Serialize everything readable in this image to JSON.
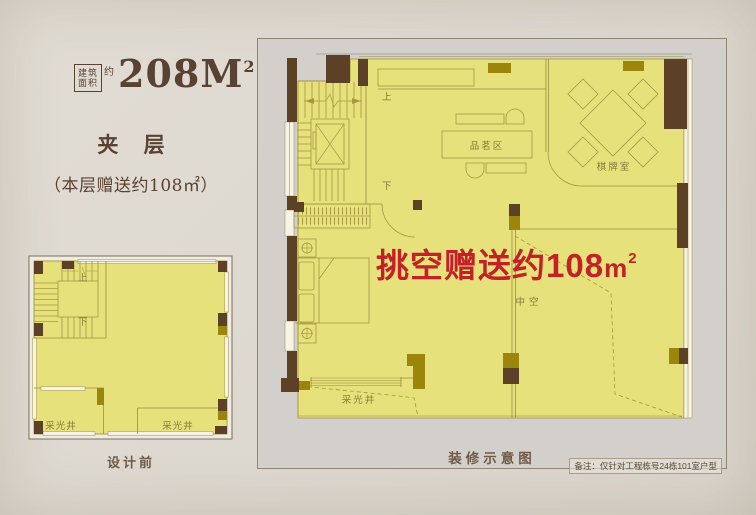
{
  "page": {
    "background": "#ddd8d0"
  },
  "header": {
    "area_box_line1": "建筑",
    "area_box_line2": "面积",
    "area_approx": "约",
    "area_value": "208M",
    "area_exp": "2",
    "floor_title": "夹 层",
    "floor_note": "（本层赠送约108㎡）"
  },
  "before_plan": {
    "caption": "设计前",
    "labels": {
      "up": "上",
      "down": "下",
      "lightwell_left": "采光井",
      "lightwell_right": "采光井"
    }
  },
  "after_plan": {
    "caption": "装修示意图",
    "footnote": "备注：仅针对工程栋号24栋101室户型",
    "highlight": {
      "text": "挑空赠送约108",
      "unit": "m",
      "exp": "2"
    },
    "labels": {
      "up": "上",
      "down": "下",
      "tea_area": "品茗区",
      "chess_room": "棋牌室",
      "void": "中空",
      "lightwell": "采光井"
    }
  },
  "colors": {
    "accent_red": "#c3202a",
    "plan_yellow": "#e7e17b",
    "wall_brown": "#5d4126",
    "wall_olive": "#9b860b",
    "text_brown": "#5a4233"
  }
}
